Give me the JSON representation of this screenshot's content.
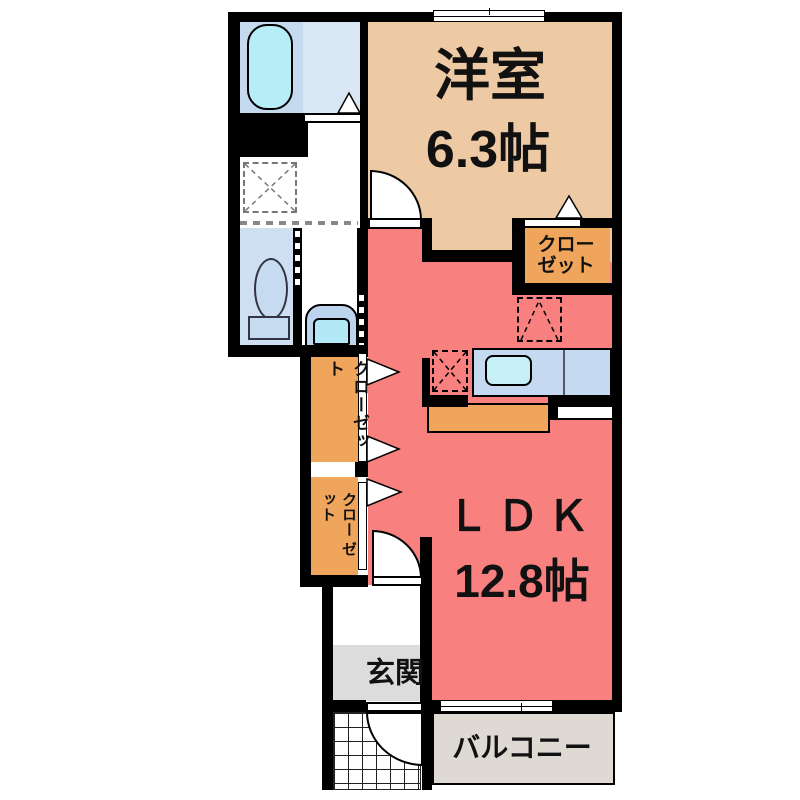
{
  "floorplan": {
    "rooms": {
      "bedroom": {
        "name": "洋室",
        "size": "6.3帖"
      },
      "ldk": {
        "name": "ＬＤＫ",
        "size": "12.8帖"
      },
      "bedroom_closet": {
        "line1": "クロー",
        "line2": "ゼット"
      },
      "hall_closet_upper": {
        "label": "クローゼット"
      },
      "hall_closet_lower": {
        "col1": "クロー",
        "col2": "ゼット"
      },
      "entrance": {
        "name": "玄関"
      },
      "balcony": {
        "name": "バルコニー"
      }
    },
    "colors": {
      "wall": "#000000",
      "ldk-floor": "#f8807f",
      "bedroom-floor": "#edcaa4",
      "closet-fill": "#efa55c",
      "entrance-floor": "#dcdcdc",
      "balcony-floor": "#ded9d2",
      "bath-floor": "#c5daee",
      "bath-floor-light": "#d9e7f4",
      "tub-fill": "#b7edf7",
      "toilet-floor": "#cfdff2",
      "fixture-blue": "#c6dbf0",
      "counter-fill": "#c5daf0",
      "sink-fill": "#c6eff8",
      "washbasin-fill": "#bcd4ee",
      "basin-fill": "#b3e9f6"
    }
  }
}
